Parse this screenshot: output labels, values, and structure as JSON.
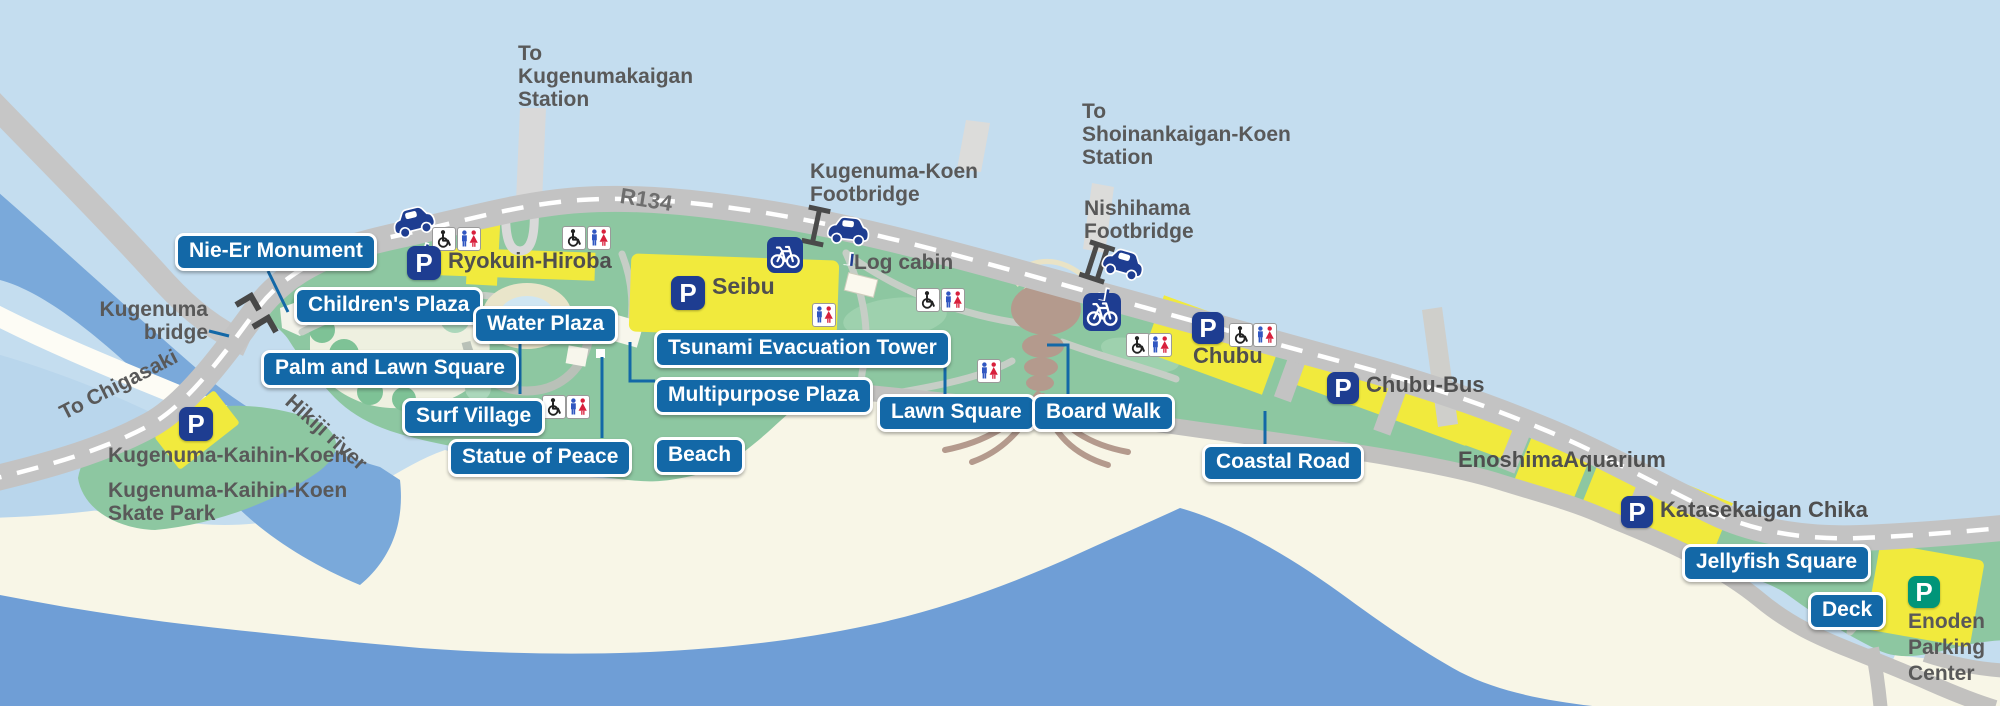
{
  "colors": {
    "label_blue": "#1368a7",
    "park_green": "#8dc7a1",
    "parking_yellow": "#f1ea3d",
    "icon_navy": "#1e3d91",
    "enoden_green": "#009579",
    "sea_blue": "#6f9ed6",
    "river_blue": "#7aa9da",
    "road_gray": "#c3c3c3",
    "text_gray": "#595959"
  },
  "map_labels": {
    "nie_er": "Nie-Er Monument",
    "childrens_plaza": "Children's Plaza",
    "water_plaza": "Water Plaza",
    "palm_lawn": "Palm and Lawn Square",
    "surf_village": "Surf Village",
    "statue_peace": "Statue of Peace",
    "tsunami_tower": "Tsunami Evacuation Tower",
    "multipurpose": "Multipurpose Plaza",
    "beach": "Beach",
    "lawn_square": "Lawn Square",
    "board_walk": "Board Walk",
    "coastal_road": "Coastal Road",
    "jellyfish_square": "Jellyfish Square",
    "deck": "Deck"
  },
  "places": {
    "ryokuin": "Ryokuin-Hiroba",
    "seibu": "Seibu",
    "chubu": "Chubu",
    "chubu_bus": "Chubu-Bus",
    "aquarium": "EnoshimaAquarium",
    "katasekaigan": "Katasekaigan Chika",
    "log_cabin": "Log cabin",
    "kkk": "Kugenuma-Kaihin-Koen",
    "kkk_skate_1": "Kugenuma-Kaihin-Koen",
    "kkk_skate_2": "Skate Park",
    "enoden_1": "Enoden",
    "enoden_2": "Parking",
    "enoden_3": "Center"
  },
  "directions": {
    "to_kugenumakaigan_1": "To",
    "to_kugenumakaigan_2": "Kugenumakaigan",
    "to_kugenumakaigan_3": "Station",
    "to_shoinankaigan_1": "To",
    "to_shoinankaigan_2": "Shoinankaigan-Koen",
    "to_shoinankaigan_3": "Station",
    "kugenuma_koen_fb_1": "Kugenuma-Koen",
    "kugenuma_koen_fb_2": "Footbridge",
    "nishihama_fb_1": "Nishihama",
    "nishihama_fb_2": "Footbridge",
    "kugenuma_bridge_1": "Kugenuma",
    "kugenuma_bridge_2": "bridge",
    "to_chigasaki": "To Chigasaki",
    "hikiji_river": "Hikiji river",
    "r134": "R134"
  },
  "parking_letter": "P"
}
